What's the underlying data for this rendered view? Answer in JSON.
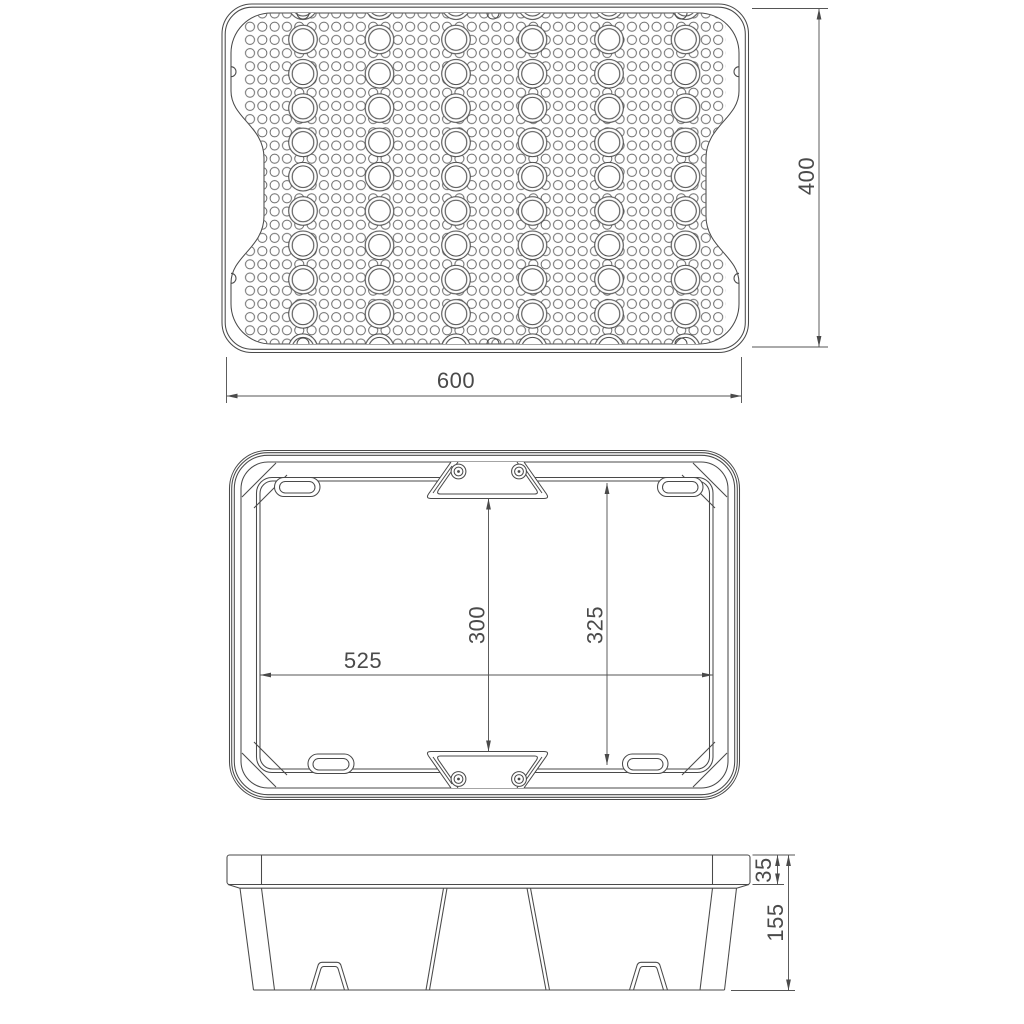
{
  "drawing": {
    "description": "technical-drawing-three-views-of-perforated-drip-tray",
    "colors": {
      "line": "#4a4a4a",
      "dim_line": "#555555",
      "dim_text": "#4a4a4a",
      "background": "#ffffff"
    },
    "views": {
      "top": {
        "dim_width": "600",
        "dim_height": "400"
      },
      "underside": {
        "dim_width": "525",
        "dim_inner_height": "300",
        "dim_outer_height": "325"
      },
      "side": {
        "dim_rim_height": "35",
        "dim_total_height": "155"
      }
    }
  }
}
